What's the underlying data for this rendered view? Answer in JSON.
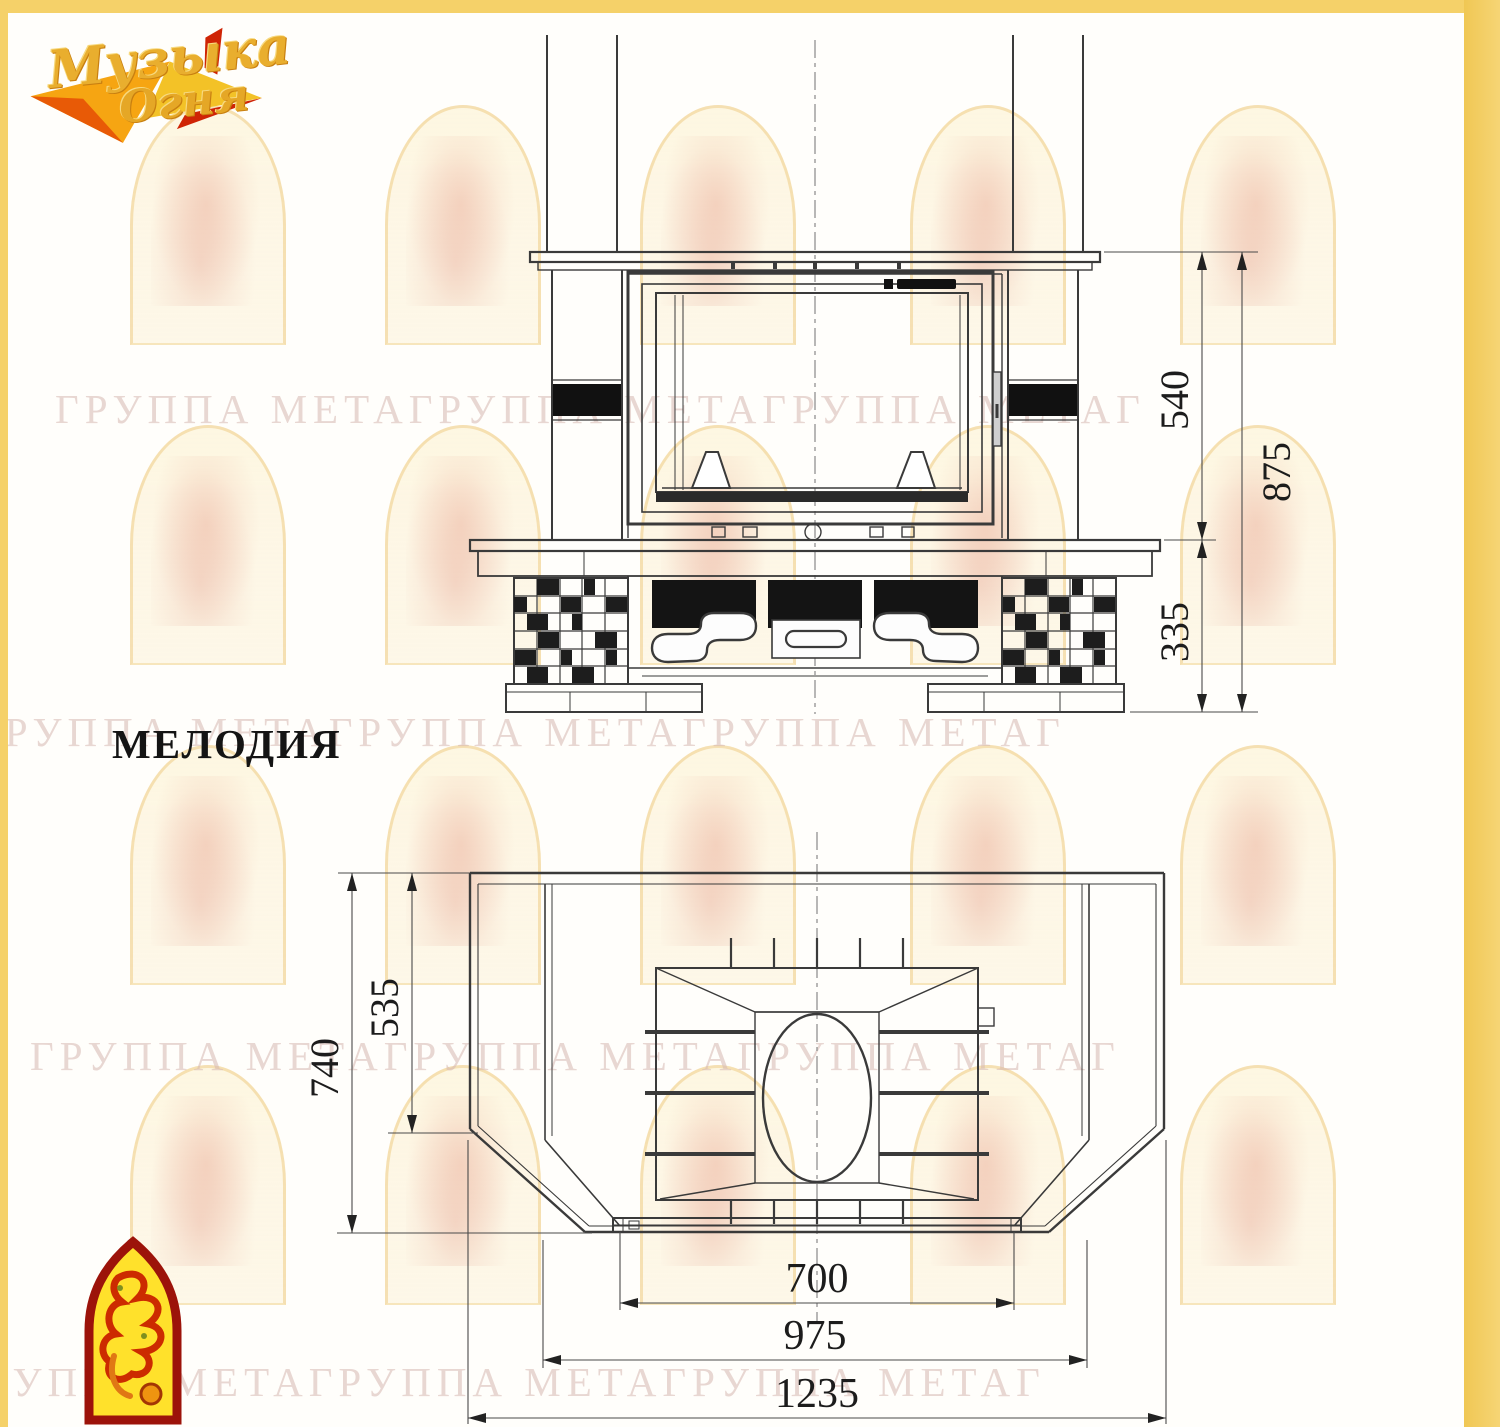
{
  "model_title": "МЕЛОДИЯ",
  "logo": {
    "line1": "Музыка",
    "line2": "Огня"
  },
  "watermark": {
    "rows": [
      "ГРУППА МЕТАГРУППА МЕТАГРУППА МЕТАГ",
      "ГРУППА МЕТАГРУППА МЕТАГРУППА МЕТАГ",
      "ГРУППА МЕТАГРУППА МЕТАГРУППА МЕТАГ",
      "ГРУППА МЕТАГРУППА МЕТАГРУППА МЕТАГ"
    ]
  },
  "front_view": {
    "dims": {
      "firebox_height": "540",
      "base_height": "335",
      "total_height": "875"
    }
  },
  "plan_view": {
    "dims": {
      "inner_depth": "535",
      "total_depth": "740",
      "opening_width": "700",
      "inner_width": "975",
      "total_width": "1235"
    }
  },
  "colors": {
    "frame_yellow": "#f5d169",
    "line": "#3a3a3a",
    "watermark_text": "#d6b6b1",
    "logo_gold": "#e9ae2e",
    "logo_red": "#cf2405"
  }
}
